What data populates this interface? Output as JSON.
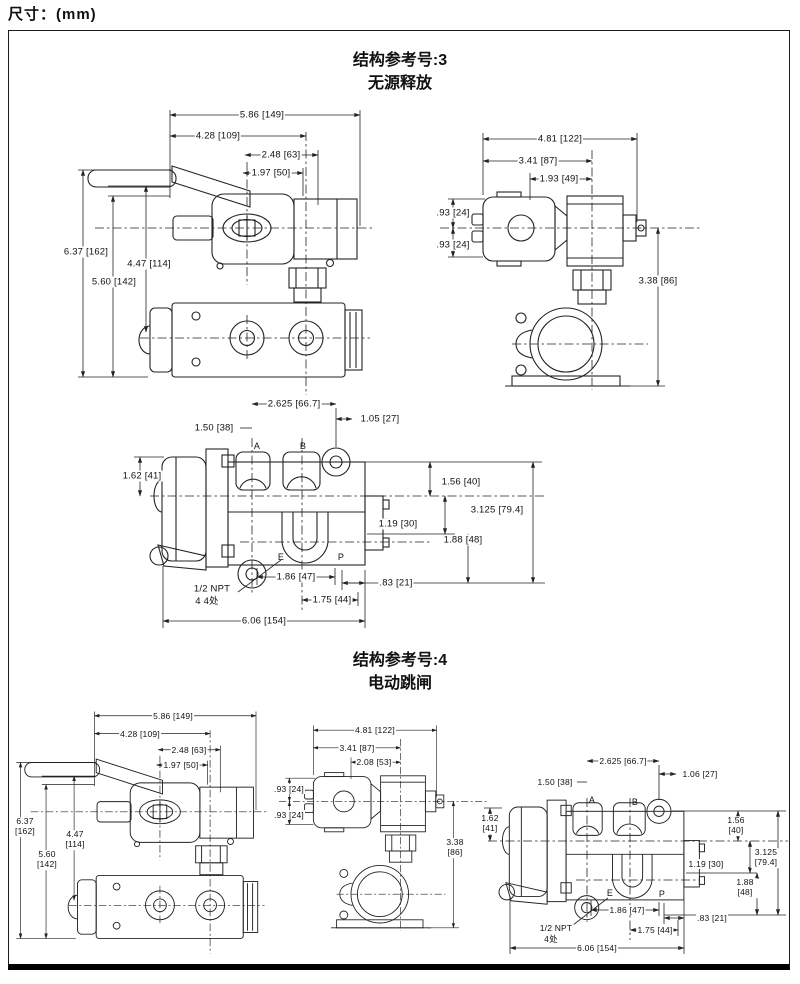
{
  "page": {
    "dim_note": "尺寸：(mm)"
  },
  "colors": {
    "ink": "#1a1a1a",
    "paper": "#ffffff"
  },
  "sections": [
    {
      "ref_title": "结构参考号:3",
      "subtitle": "无源释放",
      "side_view": {
        "dims": {
          "w1": "5.86 [149]",
          "w2": "4.28 [109]",
          "w3": "2.48 [63]",
          "w4": "1.97 [50]",
          "h1": "6.37 [162]",
          "h2": "4.47 [114]",
          "h3": "5.60 [142]"
        }
      },
      "end_view": {
        "dims": {
          "w1": "4.81 [122]",
          "w2": "3.41 [87]",
          "w3": "1.93 [49]",
          "h1": ".93 [24]",
          "h2": ".93 [24]",
          "h3": "3.38 [86]"
        }
      },
      "port_view": {
        "dims": {
          "w1": "2.625 [66.7]",
          "w2": "1.05 [27]",
          "w3": "1.50 [38]",
          "h1": "1.62 [41]",
          "h2": "1.56 [40]",
          "h3": "3.125 [79.4]",
          "h4": "1.19 [30]",
          "h5": "1.88 [48]",
          "b1": "1.86 [47]",
          "b2": ".83 [21]",
          "b3": "1.75 [44]",
          "b4": "6.06 [154]"
        },
        "ports": {
          "a": "A",
          "b": "B",
          "e": "E",
          "p": "P"
        },
        "npt_note_line1": "1/2 NPT",
        "npt_note_line2": "4 4处"
      }
    },
    {
      "ref_title": "结构参考号:4",
      "subtitle": "电动跳闸",
      "side_view": {
        "dims": {
          "w1": "5.86 [149]",
          "w2": "4.28 [109]",
          "w3": "2.48 [63]",
          "w4": "1.97 [50]",
          "h1": "6.37 [162]",
          "h2": "4.47 [114]",
          "h3": "5.60 [142]"
        }
      },
      "end_view": {
        "dims": {
          "w1": "4.81 [122]",
          "w2": "3.41 [87]",
          "w3": "2.08 [53]",
          "h1": ".93 [24]",
          "h2": ".93 [24]",
          "h3": "3.38 [86]"
        }
      },
      "port_view": {
        "dims": {
          "w1": "2.625 [66.7]",
          "w2": "1.06 [27]",
          "w3": "1.50 [38]",
          "h1": "1.62 [41]",
          "h2": "1.56 [40]",
          "h3": "3.125 [79.4]",
          "h4": "1.19 [30]",
          "h5": "1.88 [48]",
          "b1": "1.86 [47]",
          "b2": ".83 [21]",
          "b3": "1.75 [44]",
          "b4": "6.06 [154]"
        },
        "ports": {
          "a": "A",
          "b": "B",
          "e": "E",
          "p": "P"
        },
        "npt_note_line1": "1/2 NPT",
        "npt_note_line2": "4处"
      }
    }
  ]
}
